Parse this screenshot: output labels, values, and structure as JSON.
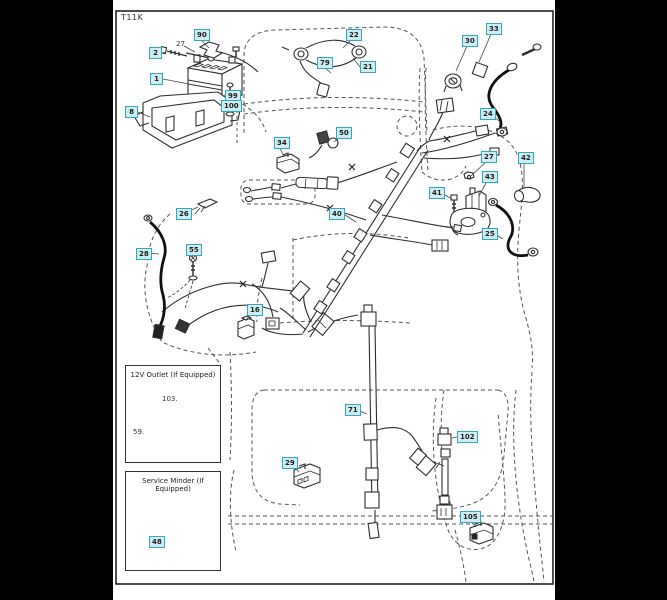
{
  "diagram": {
    "code": "T11K"
  },
  "colors": {
    "background": "#000000",
    "page": "#ffffff",
    "line": "#2e2e2e",
    "dashed_outline": "#555555",
    "cable": "#111111",
    "callout_bg": "#cfecf2",
    "callout_border": "#2fa9bc"
  },
  "insets": {
    "outlet": {
      "title": "12V Outlet (If Equipped)"
    },
    "service": {
      "title": "Service Minder (If Equipped)"
    }
  },
  "callouts": [
    {
      "label": "90"
    },
    {
      "label": "2"
    },
    {
      "label": "1"
    },
    {
      "label": "8"
    },
    {
      "label": "99"
    },
    {
      "label": "100"
    },
    {
      "label": "22"
    },
    {
      "label": "79"
    },
    {
      "label": "21"
    },
    {
      "label": "30"
    },
    {
      "label": "33"
    },
    {
      "label": "24"
    },
    {
      "label": "34"
    },
    {
      "label": "50"
    },
    {
      "label": "26"
    },
    {
      "label": "28"
    },
    {
      "label": "55"
    },
    {
      "label": "40"
    },
    {
      "label": "41"
    },
    {
      "label": "27"
    },
    {
      "label": "43"
    },
    {
      "label": "42"
    },
    {
      "label": "25"
    },
    {
      "label": "16"
    },
    {
      "label": "29"
    },
    {
      "label": "71"
    },
    {
      "label": "102"
    },
    {
      "label": "105"
    },
    {
      "label": "48"
    }
  ],
  "plain_labels": [
    {
      "label": "27"
    },
    {
      "label": "103."
    },
    {
      "label": "59."
    }
  ]
}
